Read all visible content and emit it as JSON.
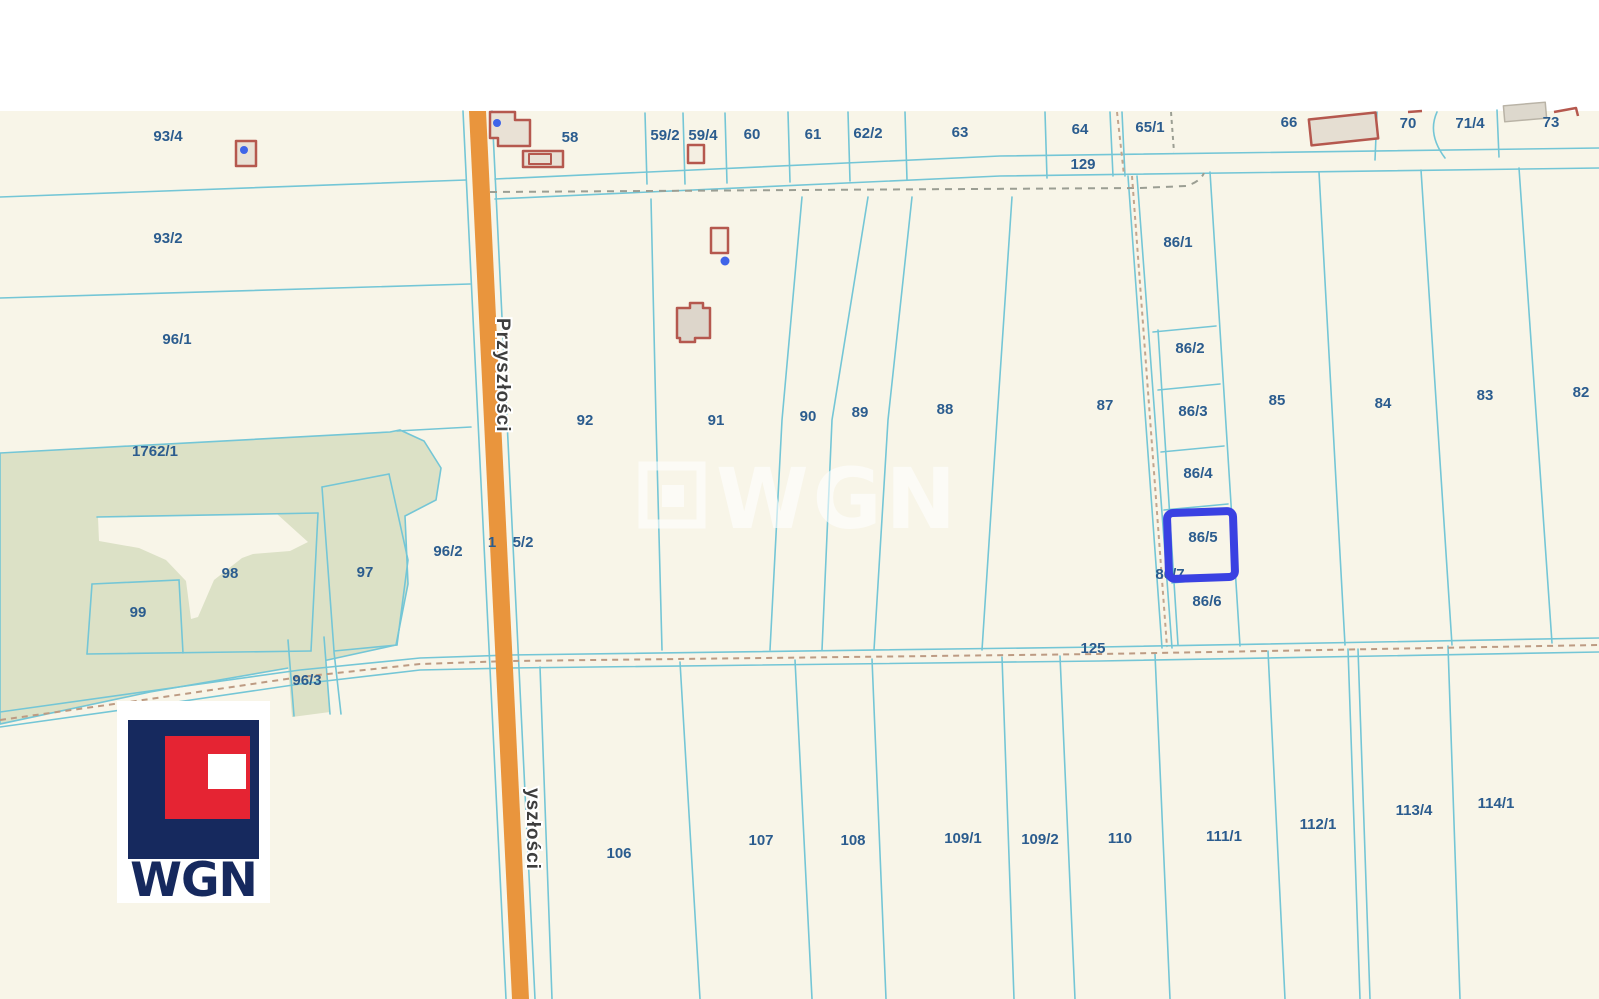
{
  "map": {
    "background_color": "#f8f5e8",
    "green_area_color": "#dce1c6",
    "boundary_line_color": "#74c6d6",
    "road_color": "#e9953d",
    "label_color": "#2b5c8e",
    "highlight_color": "#3a41e2",
    "building_outline_color": "#b5584e",
    "blue_dot_color": "#3f64e8",
    "street_name": "Przyszłości",
    "street_name_partial": "yszłości",
    "highlighted_parcel": "86/5",
    "parcel_labels": [
      {
        "text": "93/4",
        "x": 168,
        "y": 141
      },
      {
        "text": "58",
        "x": 570,
        "y": 142
      },
      {
        "text": "59/2",
        "x": 665,
        "y": 140
      },
      {
        "text": "59/4",
        "x": 703,
        "y": 140
      },
      {
        "text": "60",
        "x": 752,
        "y": 139
      },
      {
        "text": "61",
        "x": 813,
        "y": 139
      },
      {
        "text": "62/2",
        "x": 868,
        "y": 138
      },
      {
        "text": "63",
        "x": 960,
        "y": 137
      },
      {
        "text": "64",
        "x": 1080,
        "y": 134
      },
      {
        "text": "65/1",
        "x": 1150,
        "y": 132
      },
      {
        "text": "66",
        "x": 1289,
        "y": 127
      },
      {
        "text": "70",
        "x": 1408,
        "y": 128
      },
      {
        "text": "71/4",
        "x": 1470,
        "y": 128
      },
      {
        "text": "73",
        "x": 1551,
        "y": 127
      },
      {
        "text": "93/2",
        "x": 168,
        "y": 243
      },
      {
        "text": "96/1",
        "x": 177,
        "y": 344
      },
      {
        "text": "1762/1",
        "x": 155,
        "y": 456
      },
      {
        "text": "92",
        "x": 585,
        "y": 425
      },
      {
        "text": "91",
        "x": 716,
        "y": 425
      },
      {
        "text": "90",
        "x": 808,
        "y": 421
      },
      {
        "text": "89",
        "x": 860,
        "y": 417
      },
      {
        "text": "88",
        "x": 945,
        "y": 414
      },
      {
        "text": "87",
        "x": 1105,
        "y": 410
      },
      {
        "text": "86/1",
        "x": 1178,
        "y": 247
      },
      {
        "text": "86/2",
        "x": 1190,
        "y": 353
      },
      {
        "text": "86/3",
        "x": 1193,
        "y": 416
      },
      {
        "text": "86/4",
        "x": 1198,
        "y": 478
      },
      {
        "text": "86/5",
        "x": 1203,
        "y": 542
      },
      {
        "text": "86/7",
        "x": 1170,
        "y": 579
      },
      {
        "text": "86/6",
        "x": 1207,
        "y": 606
      },
      {
        "text": "85",
        "x": 1277,
        "y": 405
      },
      {
        "text": "84",
        "x": 1383,
        "y": 408
      },
      {
        "text": "83",
        "x": 1485,
        "y": 400
      },
      {
        "text": "82",
        "x": 1581,
        "y": 397
      },
      {
        "text": "98",
        "x": 230,
        "y": 578
      },
      {
        "text": "99",
        "x": 138,
        "y": 617
      },
      {
        "text": "97",
        "x": 365,
        "y": 577
      },
      {
        "text": "96/2",
        "x": 448,
        "y": 556
      },
      {
        "text": "1",
        "x": 492,
        "y": 547
      },
      {
        "text": "5/2",
        "x": 523,
        "y": 547
      },
      {
        "text": "96/3",
        "x": 307,
        "y": 685
      },
      {
        "text": "106",
        "x": 619,
        "y": 858
      },
      {
        "text": "107",
        "x": 761,
        "y": 845
      },
      {
        "text": "108",
        "x": 853,
        "y": 845
      },
      {
        "text": "109/1",
        "x": 963,
        "y": 843
      },
      {
        "text": "109/2",
        "x": 1040,
        "y": 844
      },
      {
        "text": "110",
        "x": 1120,
        "y": 843
      },
      {
        "text": "111/1",
        "x": 1224,
        "y": 841
      },
      {
        "text": "112/1",
        "x": 1318,
        "y": 829
      },
      {
        "text": "113/4",
        "x": 1414,
        "y": 815
      },
      {
        "text": "114/1",
        "x": 1496,
        "y": 808
      }
    ],
    "road_labels": [
      {
        "text": "129",
        "x": 1083,
        "y": 169
      },
      {
        "text": "125",
        "x": 1093,
        "y": 653
      }
    ]
  },
  "watermark": {
    "text": "WGN"
  },
  "logo": {
    "text": "WGN",
    "navy": "#16295e",
    "red": "#e52433"
  }
}
